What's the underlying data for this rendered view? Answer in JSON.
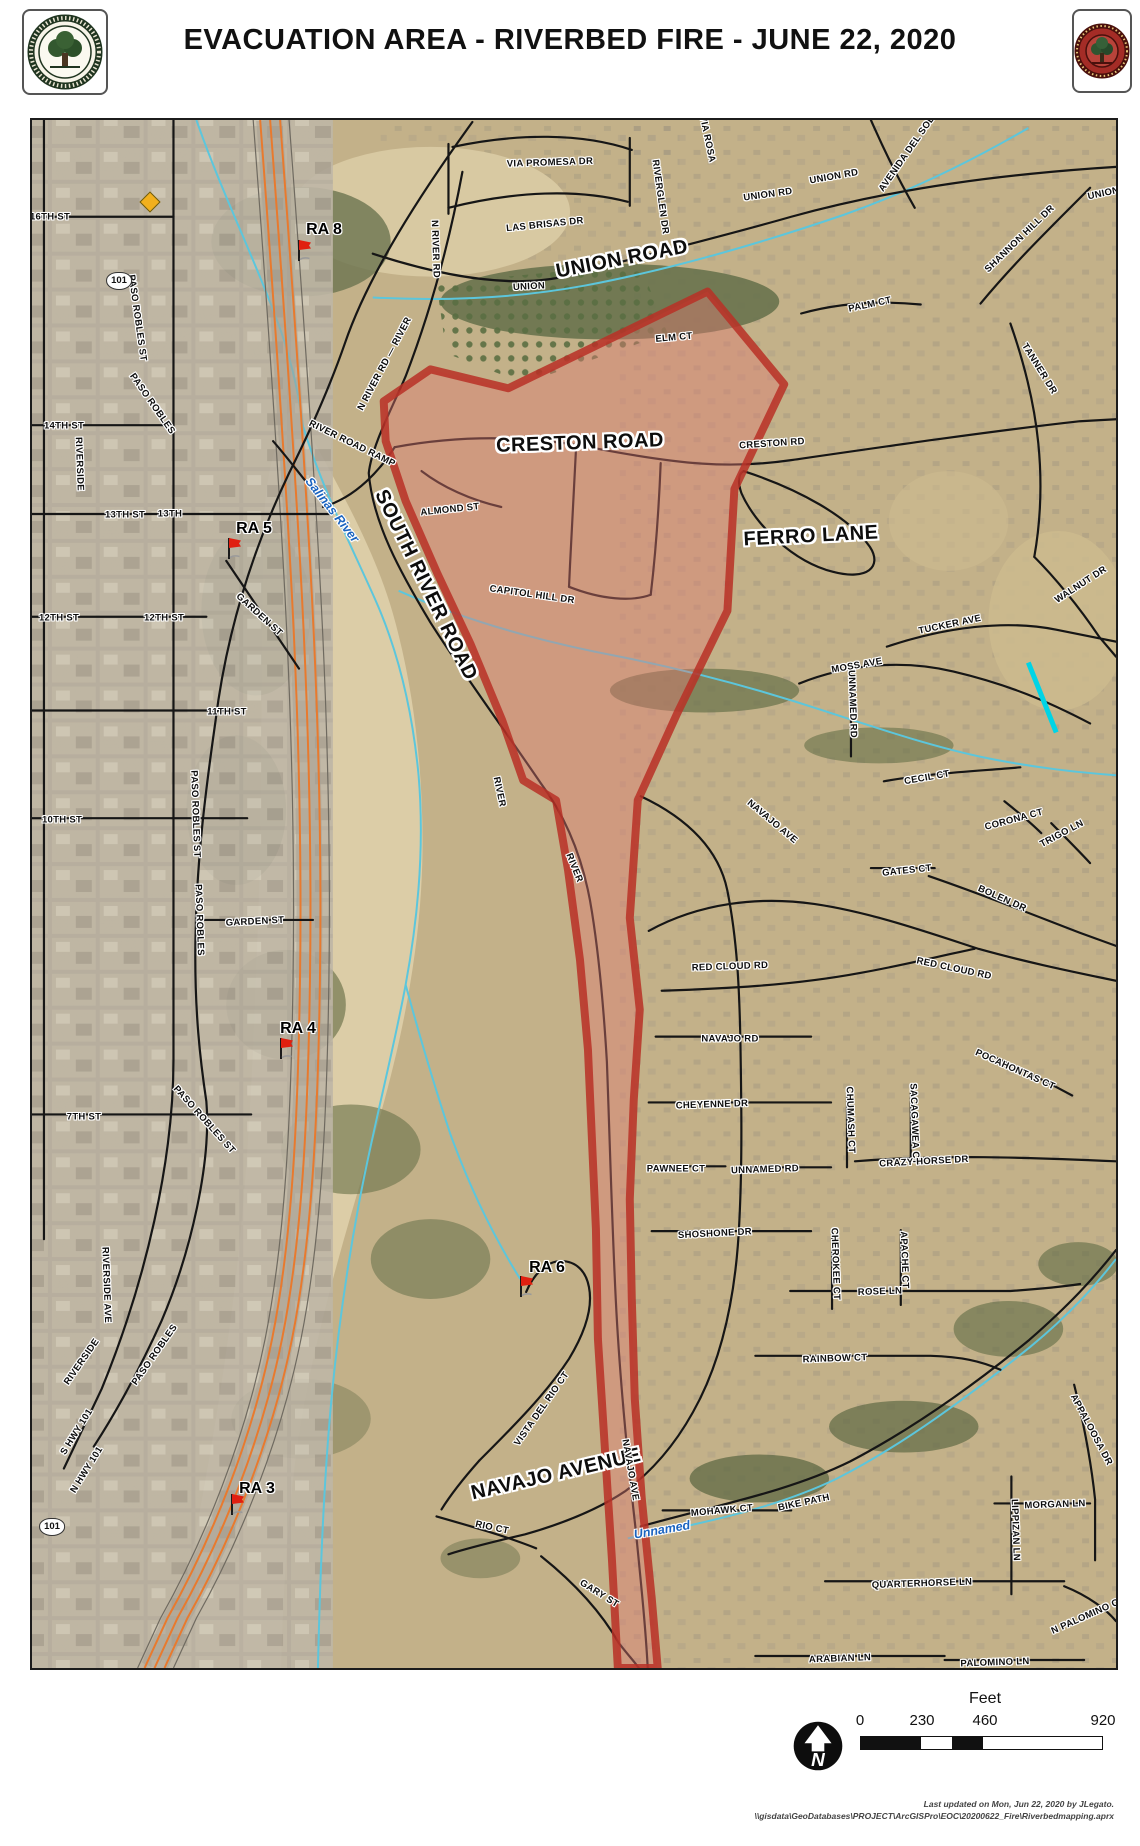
{
  "header": {
    "title": "EVACUATION AREA - RIVERBED FIRE - JUNE 22, 2020",
    "left_seal": "CITY OF EL PASO DE ROBLES",
    "right_seal": "CITY OF PASO ROBLES FIRE"
  },
  "map": {
    "zone": {
      "name": "evacuation-area",
      "fill": "rgba(224,122,114,0.42)",
      "stroke": "rgba(185,48,38,0.85)",
      "path": "M708,290 L785,383 L735,488 L728,610 L678,712 L638,800 L630,918 L640,1010 L634,1100 L630,1200 L632,1300 L635,1400 L642,1500 L652,1600 L658,1670 L618,1670 L612,1560 L605,1450 L598,1340 L596,1230 L592,1140 L588,1050 L580,960 L568,870 L556,800 L523,780 L502,720 L470,643 L437,573 L405,500 L385,440 L383,400 L430,368 L508,387 Z"
    },
    "labels": [
      {
        "t": "VIA PROMESA DR",
        "x": 548,
        "y": 161,
        "r": -2,
        "k": "s"
      },
      {
        "t": "LAS BRISAS DR",
        "x": 543,
        "y": 223,
        "r": -6,
        "k": "s"
      },
      {
        "t": "UNION ROAD",
        "x": 620,
        "y": 257,
        "r": -11,
        "k": "b"
      },
      {
        "t": "UNION",
        "x": 527,
        "y": 285,
        "r": -3,
        "k": "s"
      },
      {
        "t": "UNION RD",
        "x": 832,
        "y": 175,
        "r": -10,
        "k": "s"
      },
      {
        "t": "UNION RD",
        "x": 766,
        "y": 193,
        "r": -8,
        "k": "s"
      },
      {
        "t": "UNION RD",
        "x": 1110,
        "y": 190,
        "r": -12,
        "k": "s"
      },
      {
        "t": "VIA ROSA",
        "x": 705,
        "y": 137,
        "r": 78,
        "k": "s"
      },
      {
        "t": "RIVERGLEN DR",
        "x": 658,
        "y": 195,
        "r": 82,
        "k": "s"
      },
      {
        "t": "AVENIDA DEL SOL",
        "x": 905,
        "y": 152,
        "r": -55,
        "k": "s"
      },
      {
        "t": "SHANNON HILL DR",
        "x": 1018,
        "y": 237,
        "r": -44,
        "k": "s"
      },
      {
        "t": "PALM CT",
        "x": 868,
        "y": 303,
        "r": -12,
        "k": "s"
      },
      {
        "t": "TANNER DR",
        "x": 1037,
        "y": 367,
        "r": 58,
        "k": "s"
      },
      {
        "t": "ELM CT",
        "x": 672,
        "y": 336,
        "r": -5,
        "k": "s"
      },
      {
        "t": "16TH ST",
        "x": 48,
        "y": 215,
        "r": 0,
        "k": "s"
      },
      {
        "t": "14TH ST",
        "x": 62,
        "y": 424,
        "r": 0,
        "k": "s"
      },
      {
        "t": "13TH ST",
        "x": 123,
        "y": 513,
        "r": 0,
        "k": "s"
      },
      {
        "t": "13TH",
        "x": 168,
        "y": 512,
        "r": 0,
        "k": "s"
      },
      {
        "t": "12TH ST",
        "x": 57,
        "y": 616,
        "r": 0,
        "k": "s"
      },
      {
        "t": "12TH ST",
        "x": 162,
        "y": 616,
        "r": 0,
        "k": "s"
      },
      {
        "t": "11TH ST",
        "x": 225,
        "y": 710,
        "r": 0,
        "k": "s"
      },
      {
        "t": "10TH ST",
        "x": 60,
        "y": 818,
        "r": 0,
        "k": "s"
      },
      {
        "t": "7TH ST",
        "x": 82,
        "y": 1115,
        "r": 0,
        "k": "s"
      },
      {
        "t": "GARDEN ST",
        "x": 257,
        "y": 613,
        "r": 42,
        "k": "s"
      },
      {
        "t": "GARDEN ST",
        "x": 253,
        "y": 920,
        "r": -3,
        "k": "s"
      },
      {
        "t": "RIVERSIDE",
        "x": 77,
        "y": 462,
        "r": 88,
        "k": "s"
      },
      {
        "t": "PASO ROBLES ST",
        "x": 135,
        "y": 316,
        "r": 82,
        "k": "s"
      },
      {
        "t": "PASO ROBLES",
        "x": 150,
        "y": 402,
        "r": 55,
        "k": "s"
      },
      {
        "t": "PASO ROBLES ST",
        "x": 193,
        "y": 812,
        "r": 88,
        "k": "s"
      },
      {
        "t": "PASO ROBLES",
        "x": 197,
        "y": 918,
        "r": 88,
        "k": "s"
      },
      {
        "t": "PASO ROBLES ST",
        "x": 202,
        "y": 1118,
        "r": 48,
        "k": "s"
      },
      {
        "t": "RIVERSIDE AVE",
        "x": 104,
        "y": 1283,
        "r": 88,
        "k": "s"
      },
      {
        "t": "RIVERSIDE",
        "x": 80,
        "y": 1360,
        "r": -55,
        "k": "s"
      },
      {
        "t": "PASO ROBLES",
        "x": 153,
        "y": 1353,
        "r": -55,
        "k": "s"
      },
      {
        "t": "S HWY 101",
        "x": 75,
        "y": 1430,
        "r": -58,
        "k": "s"
      },
      {
        "t": "N HWY 101",
        "x": 85,
        "y": 1468,
        "r": -58,
        "k": "s"
      },
      {
        "t": "N RIVER RD",
        "x": 433,
        "y": 247,
        "r": 88,
        "k": "s"
      },
      {
        "t": "N RIVER RD — RIVER",
        "x": 383,
        "y": 362,
        "r": -62,
        "k": "s"
      },
      {
        "t": "RIVER ROAD RAMP",
        "x": 350,
        "y": 442,
        "r": 26,
        "k": "s"
      },
      {
        "t": "SOUTH RIVER ROAD",
        "x": 424,
        "y": 583,
        "r": 64,
        "k": "b"
      },
      {
        "t": "ALMOND ST",
        "x": 448,
        "y": 508,
        "r": -6,
        "k": "s"
      },
      {
        "t": "CAPITOL HILL DR",
        "x": 530,
        "y": 593,
        "r": 8,
        "k": "s"
      },
      {
        "t": "CRESTON ROAD",
        "x": 578,
        "y": 441,
        "r": -2,
        "k": "b"
      },
      {
        "t": "CRESTON RD",
        "x": 770,
        "y": 442,
        "r": -4,
        "k": "s"
      },
      {
        "t": "FERRO LANE",
        "x": 809,
        "y": 534,
        "r": -3,
        "k": "b"
      },
      {
        "t": "WALNUT DR",
        "x": 1079,
        "y": 583,
        "r": -33,
        "k": "s"
      },
      {
        "t": "TUCKER AVE",
        "x": 948,
        "y": 623,
        "r": -12,
        "k": "s"
      },
      {
        "t": "MOSS AVE",
        "x": 855,
        "y": 664,
        "r": -10,
        "k": "s"
      },
      {
        "t": "UNNAMED RD",
        "x": 850,
        "y": 702,
        "r": 88,
        "k": "s"
      },
      {
        "t": "CECIL CT",
        "x": 925,
        "y": 776,
        "r": -10,
        "k": "s"
      },
      {
        "t": "CORONA CT",
        "x": 1012,
        "y": 818,
        "r": -15,
        "k": "s"
      },
      {
        "t": "TRIGO LN",
        "x": 1060,
        "y": 832,
        "r": -28,
        "k": "s"
      },
      {
        "t": "GATES CT",
        "x": 905,
        "y": 869,
        "r": -6,
        "k": "s"
      },
      {
        "t": "BOLEN DR",
        "x": 1000,
        "y": 897,
        "r": 24,
        "k": "s"
      },
      {
        "t": "NAVAJO AVE",
        "x": 770,
        "y": 820,
        "r": 40,
        "k": "s"
      },
      {
        "t": "RED CLOUD RD",
        "x": 728,
        "y": 965,
        "r": -2,
        "k": "s"
      },
      {
        "t": "RED CLOUD RD",
        "x": 952,
        "y": 967,
        "r": 12,
        "k": "s"
      },
      {
        "t": "NAVAJO RD",
        "x": 728,
        "y": 1037,
        "r": 0,
        "k": "s"
      },
      {
        "t": "POCAHONTAS CT",
        "x": 1013,
        "y": 1068,
        "r": 24,
        "k": "s"
      },
      {
        "t": "CHEYENNE DR",
        "x": 710,
        "y": 1103,
        "r": -2,
        "k": "s"
      },
      {
        "t": "PAWNEE CT",
        "x": 674,
        "y": 1167,
        "r": 0,
        "k": "s"
      },
      {
        "t": "UNNAMED RD",
        "x": 763,
        "y": 1168,
        "r": -2,
        "k": "s"
      },
      {
        "t": "CHUMASH CT",
        "x": 848,
        "y": 1118,
        "r": 88,
        "k": "s"
      },
      {
        "t": "SACAGAWEA CT",
        "x": 912,
        "y": 1122,
        "r": 88,
        "k": "s"
      },
      {
        "t": "CRAZY HORSE DR",
        "x": 922,
        "y": 1160,
        "r": -3,
        "k": "s"
      },
      {
        "t": "SHOSHONE DR",
        "x": 713,
        "y": 1232,
        "r": -3,
        "k": "s"
      },
      {
        "t": "CHEROKEE CT",
        "x": 833,
        "y": 1262,
        "r": 88,
        "k": "s"
      },
      {
        "t": "APACHE CT",
        "x": 902,
        "y": 1258,
        "r": 88,
        "k": "s"
      },
      {
        "t": "ROSE LN",
        "x": 878,
        "y": 1290,
        "r": -2,
        "k": "s"
      },
      {
        "t": "RAINBOW CT",
        "x": 833,
        "y": 1357,
        "r": -2,
        "k": "s"
      },
      {
        "t": "RIVER",
        "x": 497,
        "y": 790,
        "r": 78,
        "k": "s"
      },
      {
        "t": "RIVER",
        "x": 572,
        "y": 866,
        "r": 68,
        "k": "s"
      },
      {
        "t": "VISTA DEL RIO CT",
        "x": 540,
        "y": 1407,
        "r": -55,
        "k": "s"
      },
      {
        "t": "NAVAJO AVENUE",
        "x": 554,
        "y": 1472,
        "r": -13,
        "k": "b"
      },
      {
        "t": "NAVAJO AVE",
        "x": 628,
        "y": 1468,
        "r": 80,
        "k": "s"
      },
      {
        "t": "MOHAWK CT",
        "x": 720,
        "y": 1509,
        "r": -5,
        "k": "s"
      },
      {
        "t": "BIKE PATH",
        "x": 802,
        "y": 1501,
        "r": -12,
        "k": "s"
      },
      {
        "t": "MORGAN LN",
        "x": 1053,
        "y": 1503,
        "r": -2,
        "k": "s"
      },
      {
        "t": "LIPPIZAN LN",
        "x": 1013,
        "y": 1528,
        "r": 88,
        "k": "s"
      },
      {
        "t": "APPALOOSA DR",
        "x": 1089,
        "y": 1428,
        "r": 62,
        "k": "s"
      },
      {
        "t": "QUARTERHORSE LN",
        "x": 920,
        "y": 1582,
        "r": -2,
        "k": "s"
      },
      {
        "t": "N PALOMINO CIR",
        "x": 1088,
        "y": 1613,
        "r": -24,
        "k": "s"
      },
      {
        "t": "ARABIAN LN",
        "x": 838,
        "y": 1657,
        "r": -2,
        "k": "s"
      },
      {
        "t": "PALOMINO LN",
        "x": 993,
        "y": 1661,
        "r": -2,
        "k": "s"
      },
      {
        "t": "RIO CT",
        "x": 490,
        "y": 1526,
        "r": 12,
        "k": "s"
      },
      {
        "t": "GARY ST",
        "x": 597,
        "y": 1592,
        "r": 32,
        "k": "s"
      },
      {
        "t": "Salinas River",
        "x": 330,
        "y": 508,
        "r": 52,
        "k": "w"
      },
      {
        "t": "Unnamed",
        "x": 660,
        "y": 1528,
        "r": -10,
        "k": "w"
      }
    ],
    "markers": [
      {
        "label": "RA 8",
        "lx": 322,
        "ly": 228,
        "fx": 300,
        "fy": 250
      },
      {
        "label": "RA 5",
        "lx": 252,
        "ly": 527,
        "fx": 230,
        "fy": 548
      },
      {
        "label": "RA 4",
        "lx": 296,
        "ly": 1027,
        "fx": 282,
        "fy": 1048
      },
      {
        "label": "RA 6",
        "lx": 545,
        "ly": 1266,
        "fx": 522,
        "fy": 1286
      },
      {
        "label": "RA 3",
        "lx": 255,
        "ly": 1487,
        "fx": 233,
        "fy": 1504
      }
    ],
    "shields": [
      {
        "t": "101",
        "x": 117,
        "y": 279
      },
      {
        "t": "101",
        "x": 50,
        "y": 1525
      }
    ],
    "warning_sign": {
      "x": 148,
      "y": 200
    }
  },
  "legend": {
    "scale_title": "Feet",
    "ticks": [
      "0",
      "230",
      "460",
      "920"
    ],
    "north_label": "N"
  },
  "footer": {
    "line1": "Last updated on Mon, Jun 22, 2020 by JLegato.",
    "line2": "\\\\gisdata\\GeoDatabases\\PROJECT\\ArcGISPro\\EOC\\20200622_Fire\\Riverbedmapping.aprx"
  }
}
